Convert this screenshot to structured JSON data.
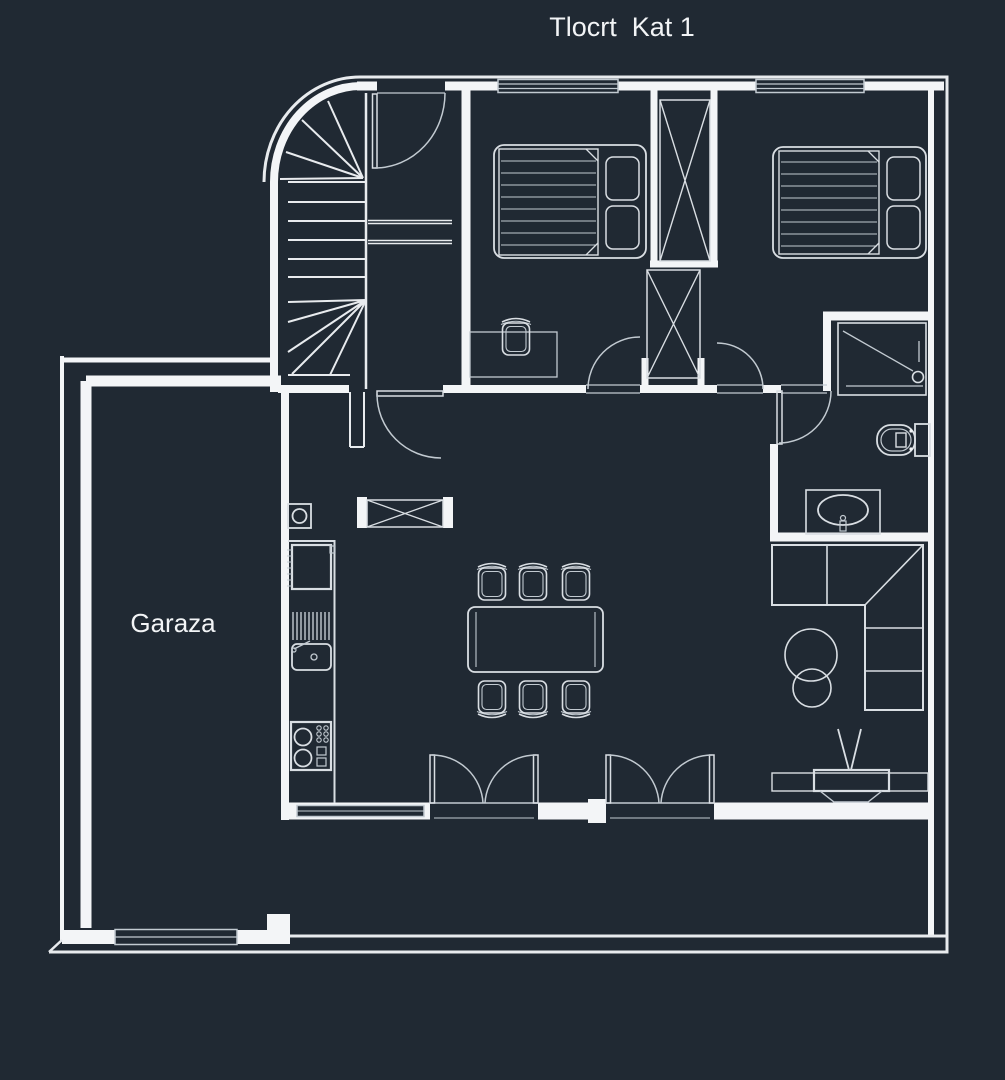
{
  "title": "Tlocrt  Kat 1",
  "labels": {
    "garage": "Garaza"
  },
  "colors": {
    "background": "#202933",
    "wall_line": "#f3f5f7",
    "furniture_line": "#d9dee3",
    "detail_line": "#c2cad1",
    "stair_line": "#e8ebee",
    "text": "#f2f4f6"
  },
  "fixtures": {
    "staircase": "winder-staircase",
    "beds": 2,
    "wardrobes_with_x": 3,
    "dining_chairs": 6,
    "dining_tables": 1,
    "desk_with_stool": 1,
    "bathroom": [
      "shower",
      "toilet",
      "washbasin"
    ],
    "kitchen": [
      "fridge",
      "dish-drainer",
      "sink",
      "stove"
    ],
    "living": [
      "corner-sofa",
      "nesting-tables",
      "tv-lowboard"
    ],
    "water_heater": 1,
    "french_doors": 2,
    "windows": 3
  }
}
